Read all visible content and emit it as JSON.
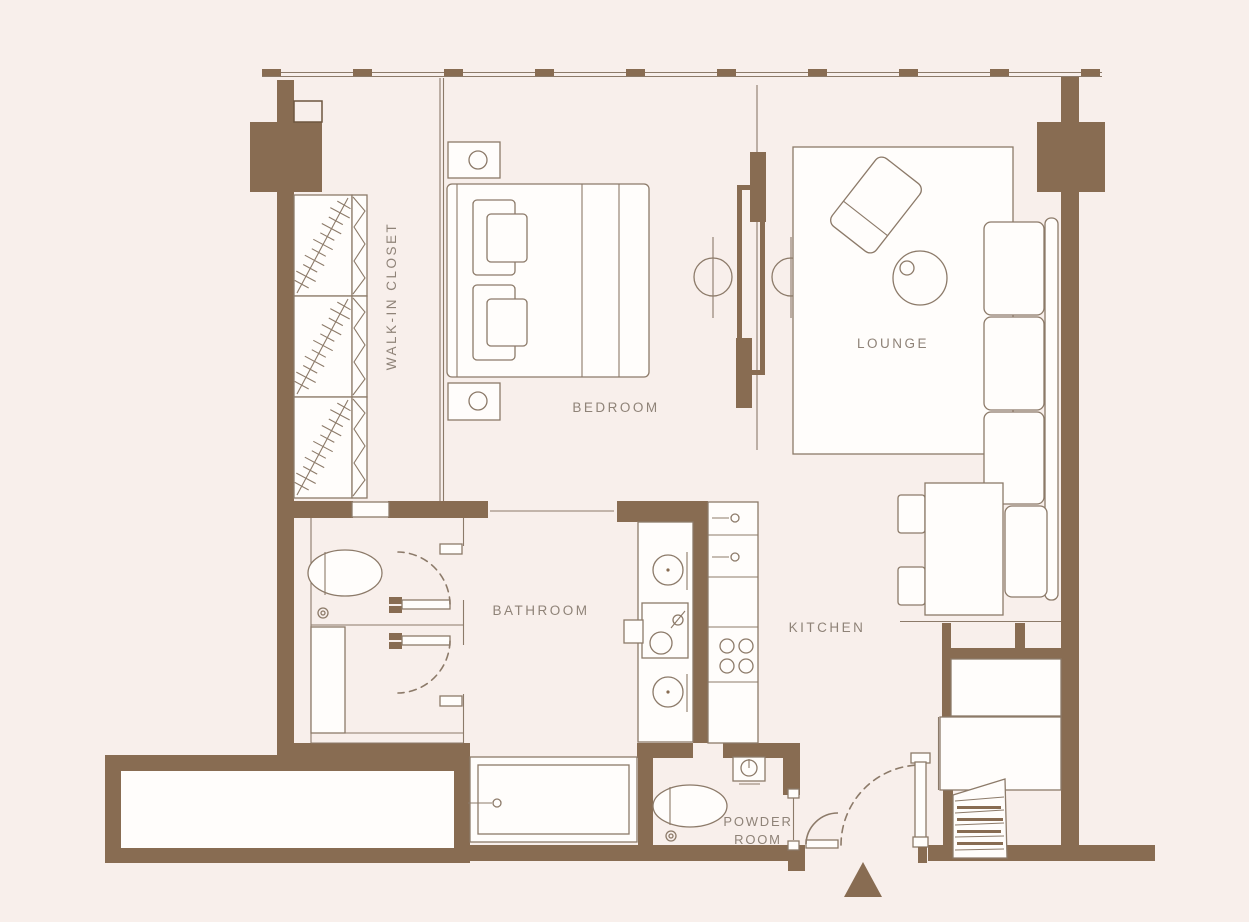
{
  "colors": {
    "background": "#f8efeb",
    "wall": "#886c52",
    "line": "#8c7a69",
    "fill": "#fffdfb",
    "text": "#8f8378"
  },
  "rooms": {
    "walk_in_closet": "WALK-IN CLOSET",
    "bedroom": "BEDROOM",
    "lounge": "LOUNGE",
    "bathroom": "BATHROOM",
    "kitchen": "KITCHEN",
    "powder_room": {
      "line1": "POWDER",
      "line2": "ROOM"
    }
  },
  "icons": {
    "entry_arrow": "solid-triangle-up-entry-marker",
    "door_swing": "dashed-quarter-arc",
    "window_mullion": "short-solid-dash-on-window-wall",
    "wardrobe_hatch": "diagonal-rail-with-hanger-ticks",
    "lamp": "circle-with-crossing-line"
  }
}
